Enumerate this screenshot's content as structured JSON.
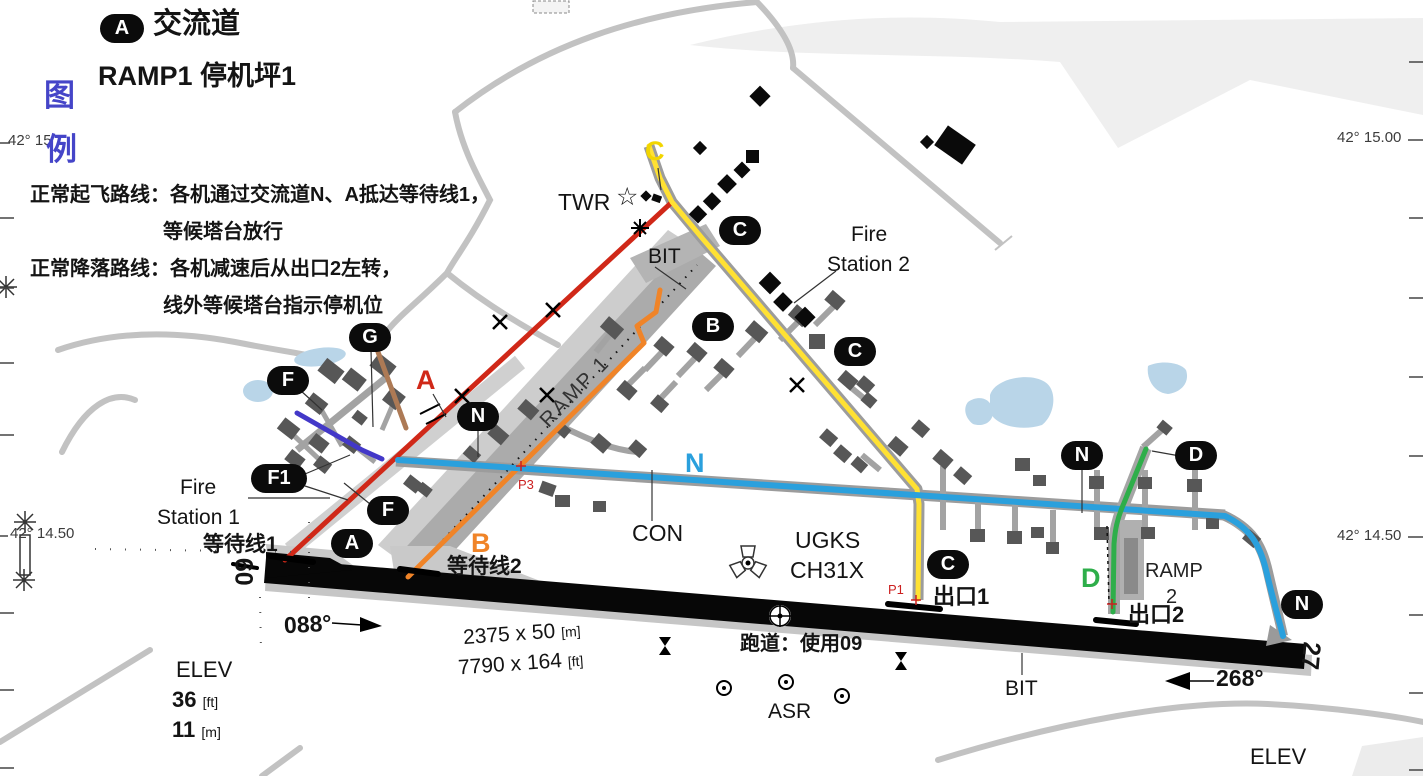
{
  "header": {
    "badge": "A",
    "taxiway_term": "交流道",
    "ramp_term": "RAMP1  停机坪1",
    "legend_char_top": "图",
    "legend_char_bottom": "例"
  },
  "notes": {
    "takeoff_1": "正常起飞路线：各机通过交流道N、A抵达等待线1，",
    "takeoff_2": "等候塔台放行",
    "landing_1": "正常降落路线：各机减速后从出口2左转，",
    "landing_2": "线外等候塔台指示停机位"
  },
  "graticule": {
    "top_left": "42° 15.00",
    "top_right": "42° 15.00",
    "mid_left": "42° 14.50",
    "mid_right": "42° 14.50"
  },
  "facilities": {
    "tower": "TWR",
    "bit_taxiway": "BIT",
    "bit_runway": "BIT",
    "fire_station_2_line1": "Fire",
    "fire_station_2_line2": "Station 2",
    "fire_station_1_line1": "Fire",
    "fire_station_1_line2": "Station 1",
    "surface_con": "CON",
    "airport_code": "UGKS",
    "airport_freq": "CH31X",
    "radar": "ASR",
    "ramp1_pavement": "RAMP 1",
    "ramp2_line1": "RAMP",
    "ramp2_line2": "2"
  },
  "runway": {
    "threshold_09": "09",
    "threshold_27": "27",
    "heading_east": "088°",
    "heading_west": "268°",
    "dim_meters": "2375 x 50",
    "dim_meters_unit": "[m]",
    "dim_feet": "7790 x 164",
    "dim_feet_unit": "[ft]",
    "in_use": "跑道：使用09"
  },
  "annotations": {
    "hold_line_1": "等待线1",
    "hold_line_2": "等待线2",
    "exit_1": "出口1",
    "exit_2": "出口2",
    "point_p1": "P1",
    "point_p3": "P3"
  },
  "elevation": {
    "label": "ELEV",
    "ft": "36",
    "ft_unit": "[ft]",
    "m": "11",
    "m_unit": "[m]",
    "corner_label": "ELEV"
  },
  "route_letters": {
    "c": "C",
    "a": "A",
    "b": "B",
    "n": "N",
    "d": "D"
  },
  "badges": [
    "C",
    "B",
    "C",
    "G",
    "F",
    "N",
    "F1",
    "F",
    "A",
    "C",
    "N",
    "D",
    "N"
  ],
  "icons": {
    "tower_star": "☆"
  },
  "colors": {
    "route_red": "#d02818",
    "route_yellow": "#ffe133",
    "route_orange": "#f08428",
    "route_cyan": "#2aa0dd",
    "route_green": "#2eae4a",
    "route_violet": "#4338c8",
    "route_brown": "#ad7a55",
    "legend_blue": "#4545c8",
    "water": "#b9d5e8",
    "runway": "#070707"
  }
}
